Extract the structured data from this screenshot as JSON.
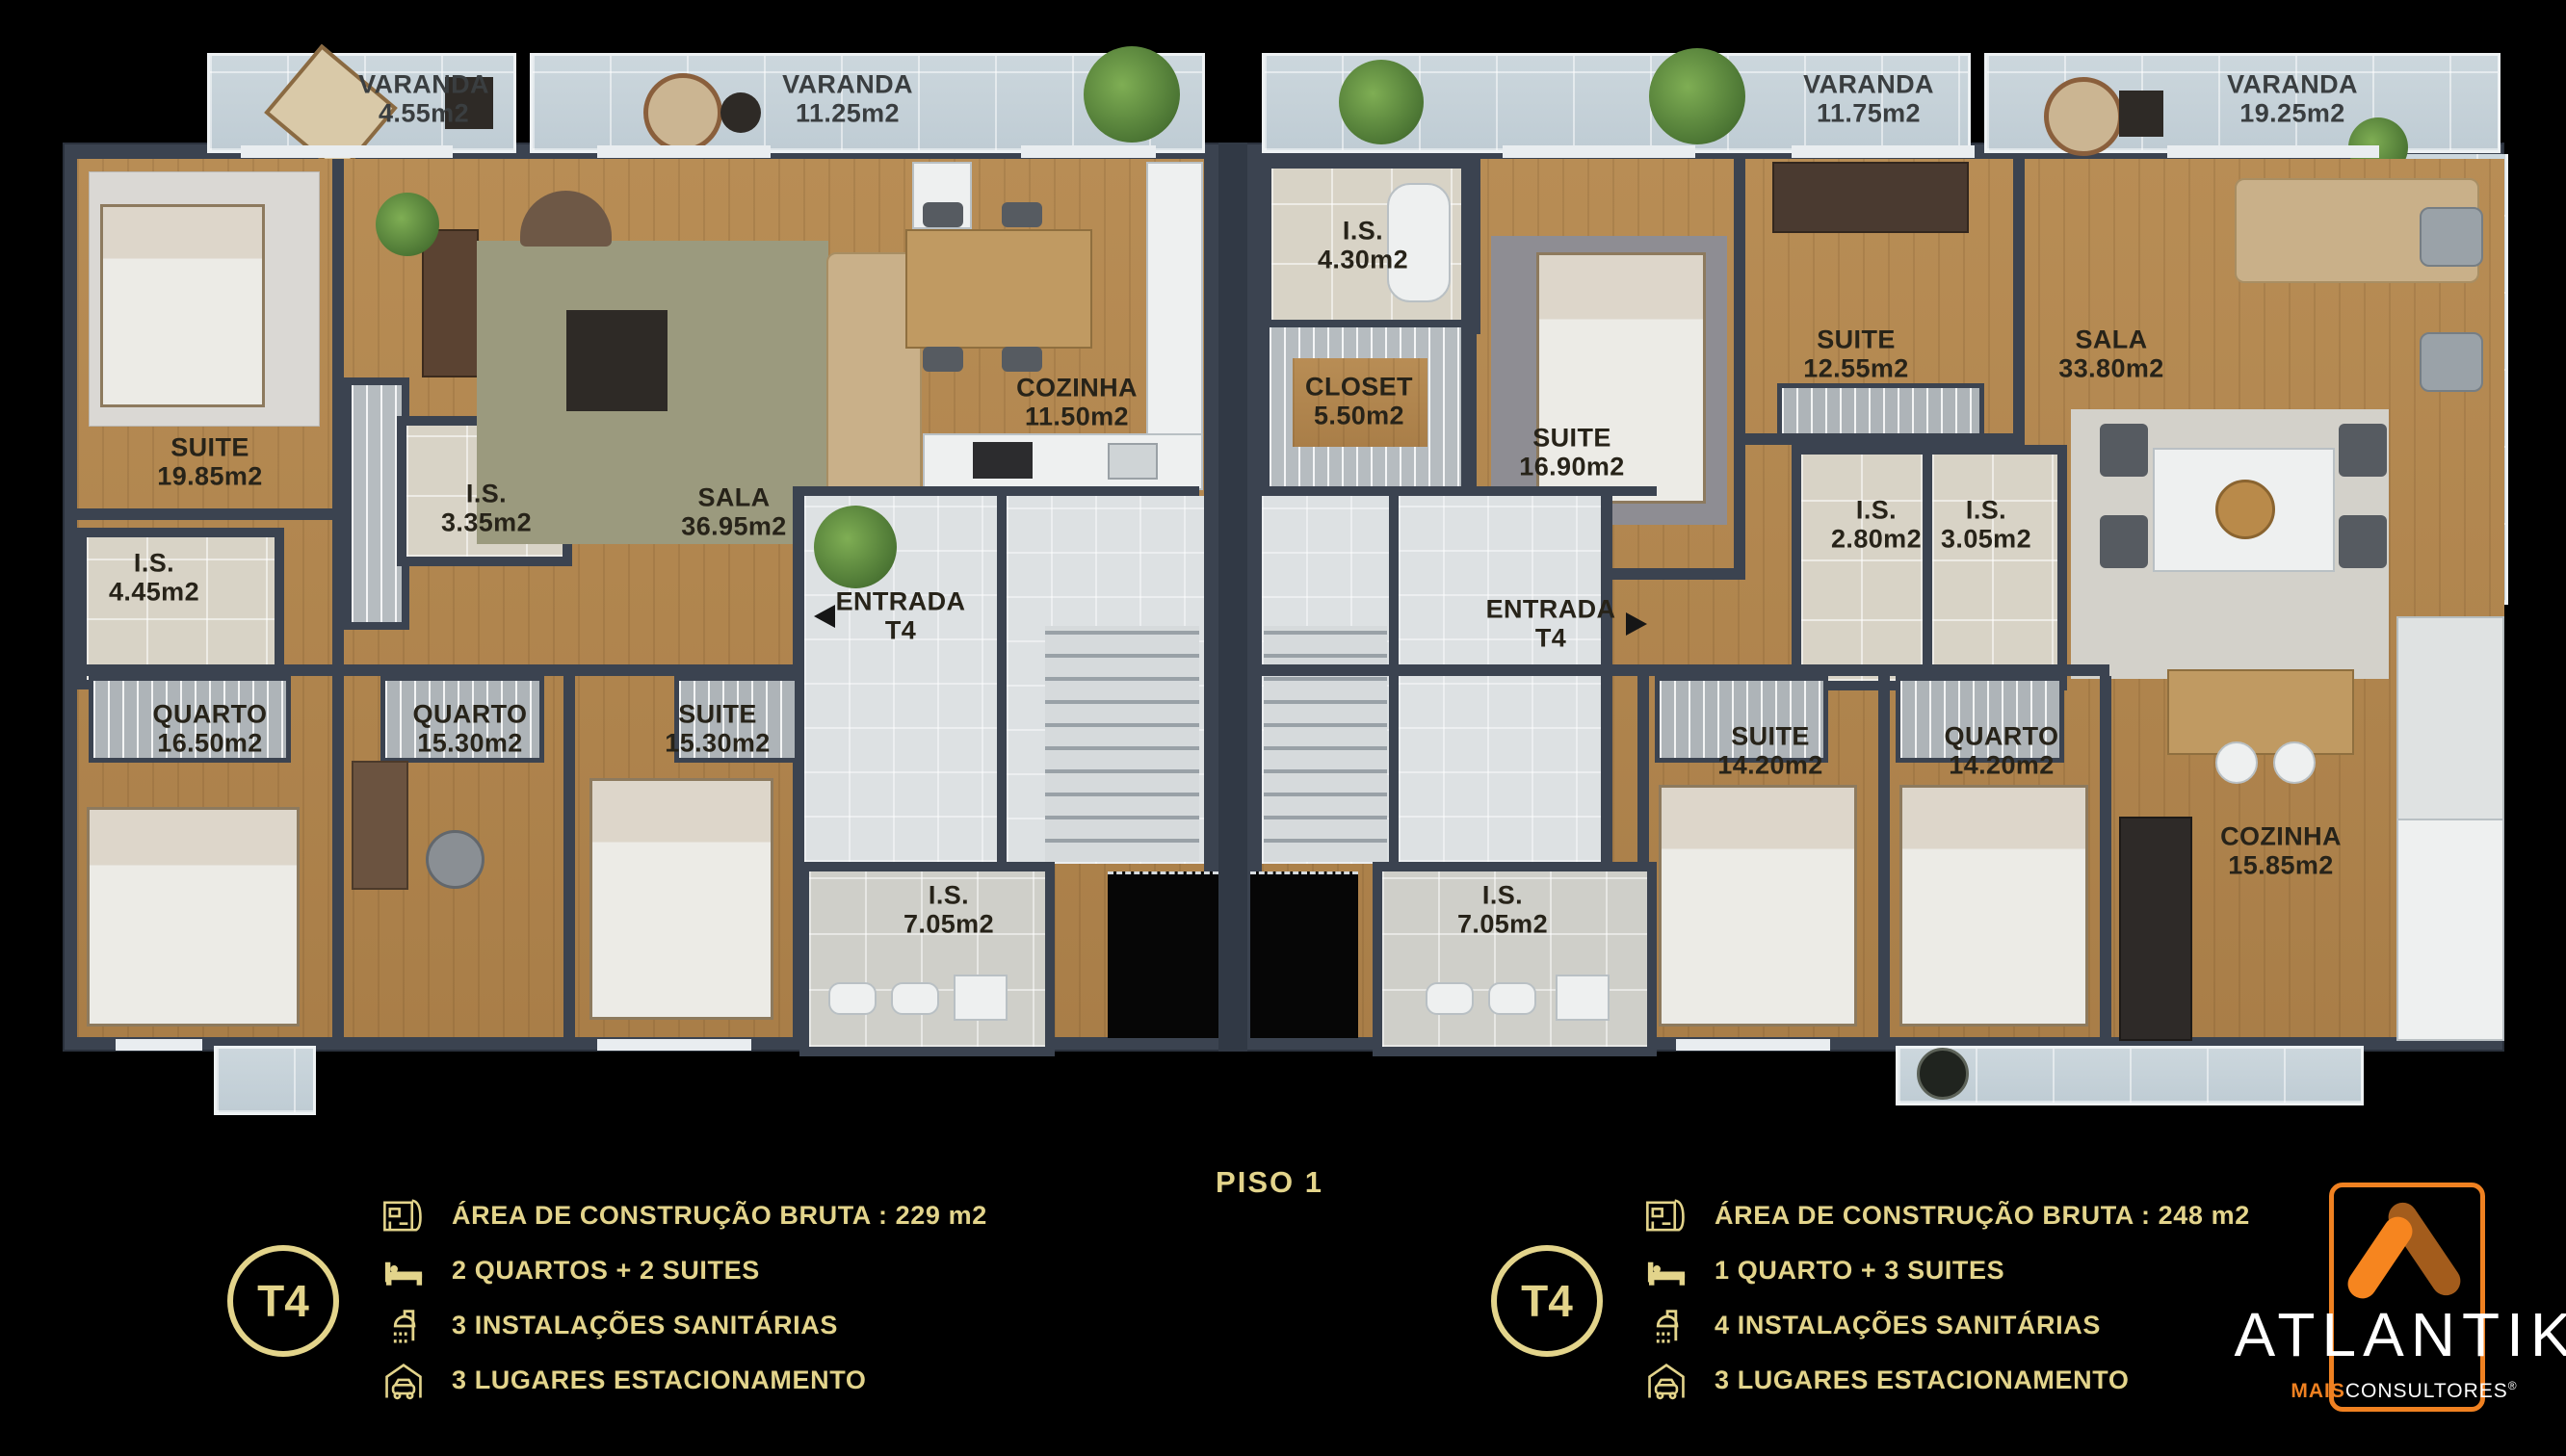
{
  "floor_label": "PISO 1",
  "plan": {
    "left_unit": {
      "balconies": [
        {
          "name": "VARANDA",
          "area": "4.55m2"
        },
        {
          "name": "VARANDA",
          "area": "11.25m2"
        }
      ],
      "entrance": {
        "line1": "ENTRADA",
        "line2": "T4"
      },
      "rooms": [
        {
          "name": "SUITE",
          "area": "19.85m2"
        },
        {
          "name": "I.S.",
          "area": "4.45m2"
        },
        {
          "name": "I.S.",
          "area": "3.35m2"
        },
        {
          "name": "SALA",
          "area": "36.95m2"
        },
        {
          "name": "COZINHA",
          "area": "11.50m2"
        },
        {
          "name": "QUARTO",
          "area": "16.50m2"
        },
        {
          "name": "QUARTO",
          "area": "15.30m2"
        },
        {
          "name": "SUITE",
          "area": "15.30m2"
        },
        {
          "name": "I.S.",
          "area": "7.05m2"
        }
      ]
    },
    "right_unit": {
      "balconies": [
        {
          "name": "VARANDA",
          "area": "11.75m2"
        },
        {
          "name": "VARANDA",
          "area": "19.25m2"
        }
      ],
      "entrance": {
        "line1": "ENTRADA",
        "line2": "T4"
      },
      "rooms": [
        {
          "name": "I.S.",
          "area": "4.30m2"
        },
        {
          "name": "CLOSET",
          "area": "5.50m2"
        },
        {
          "name": "SUITE",
          "area": "16.90m2"
        },
        {
          "name": "SUITE",
          "area": "12.55m2"
        },
        {
          "name": "I.S.",
          "area": "2.80m2"
        },
        {
          "name": "I.S.",
          "area": "3.05m2"
        },
        {
          "name": "SALA",
          "area": "33.80m2"
        },
        {
          "name": "SUITE",
          "area": "14.20m2"
        },
        {
          "name": "QUARTO",
          "area": "14.20m2"
        },
        {
          "name": "COZINHA",
          "area": "15.85m2"
        },
        {
          "name": "I.S.",
          "area": "7.05m2"
        }
      ]
    }
  },
  "legends": {
    "left": {
      "badge": "T4",
      "items": [
        {
          "icon": "blueprint-icon",
          "label": "ÁREA DE CONSTRUÇÃO BRUTA :  229 m2"
        },
        {
          "icon": "bed-icon",
          "label": "2 QUARTOS + 2 SUITES"
        },
        {
          "icon": "shower-icon",
          "label": "3 INSTALAÇÕES SANITÁRIAS"
        },
        {
          "icon": "garage-icon",
          "label": "3 LUGARES ESTACIONAMENTO"
        }
      ]
    },
    "right": {
      "badge": "T4",
      "items": [
        {
          "icon": "blueprint-icon",
          "label": "ÁREA DE CONSTRUÇÃO BRUTA :  248 m2"
        },
        {
          "icon": "bed-icon",
          "label": "1 QUARTO + 3 SUITES"
        },
        {
          "icon": "shower-icon",
          "label": "4 INSTALAÇÕES SANITÁRIAS"
        },
        {
          "icon": "garage-icon",
          "label": "3 LUGARES ESTACIONAMENTO"
        }
      ]
    }
  },
  "logo": {
    "brand": "ATLANTIK",
    "sub_bold": "MAIS",
    "sub_regular": "CONSULTORES",
    "registered": "®"
  },
  "colors": {
    "gold": "#e3d48b",
    "orange": "#f08121",
    "orange_dark": "#a35c1c",
    "wall": "#3b4350"
  }
}
